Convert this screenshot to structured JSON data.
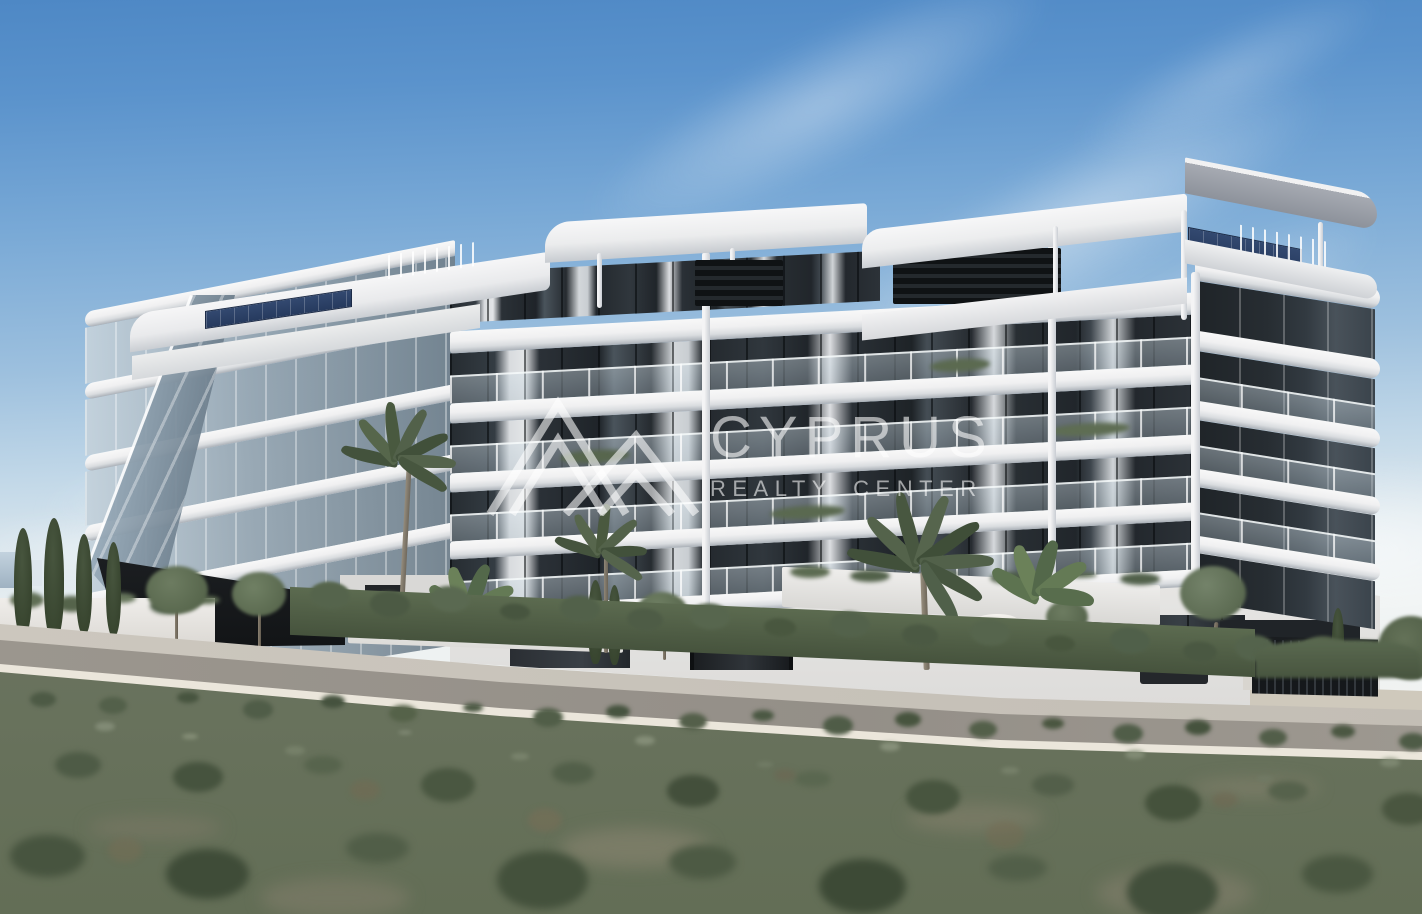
{
  "watermark": {
    "brand": "CYPRUS",
    "tagline": "REALTY CENTER",
    "logo_icon": "twin-mountain-peaks-icon",
    "color": "rgba(255,255,255,0.58)"
  },
  "scene": {
    "type": "architectural-render",
    "subject": "Modern white low-rise apartment complex with wraparound curved balconies, glass balustrades, rooftop terraces with pergolas and solar panels, landscaped with palm, olive and cypress trees behind a hedge, fronted by a road and a scrubland field under a hazy blue sky",
    "palette": {
      "sky_top": "#4e88c5",
      "sky_horizon": "#f1f2f0",
      "building_white": "#f2f2f3",
      "building_shadow": "#9aa0a8",
      "glass_dark": "#22272c",
      "curtain": "#d6dade",
      "balustrade_glass": "#c8d6de",
      "vegetation": "#5a6950",
      "cypress": "#3c4a36",
      "hedge": "#51604a",
      "field": "#68735f",
      "road_asphalt": "#9a958d",
      "curb": "#ebe6db",
      "solar_panel": "#2c4168",
      "gate_metal": "#1a1d21"
    }
  }
}
